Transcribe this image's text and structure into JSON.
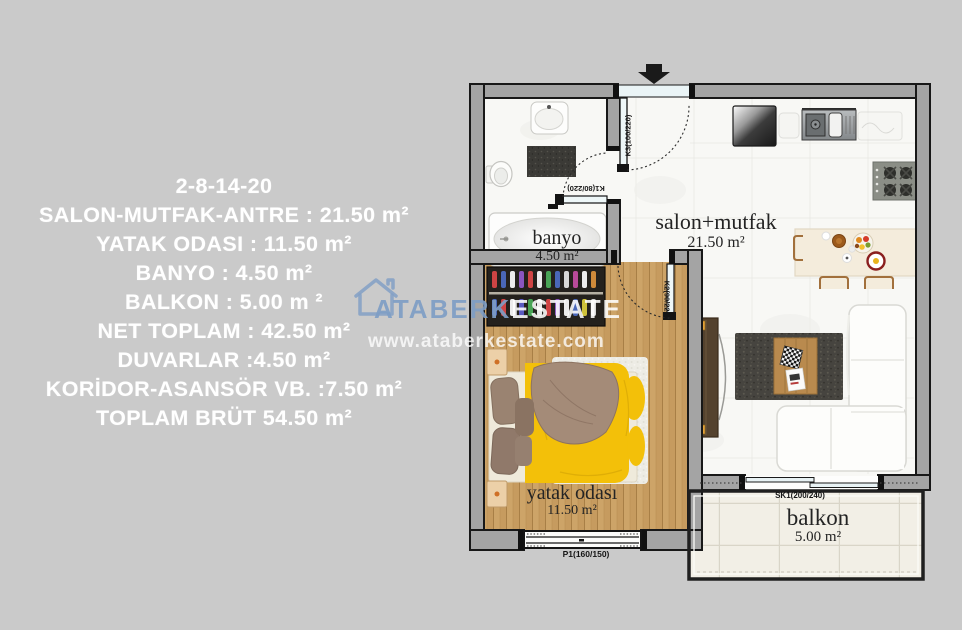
{
  "info_panel": {
    "lines": [
      "2-8-14-20",
      "SALON-MUTFAK-ANTRE  : 21.50 m²",
      "YATAK ODASI : 11.50 m²",
      "BANYO : 4.50 m²",
      "BALKON : 5.00 m ²",
      "NET TOPLAM : 42.50 m²",
      "DUVARLAR :4.50 m²",
      "KORİDOR-ASANSÖR VB. :7.50 m²",
      "TOPLAM BRÜT 54.50 m²"
    ]
  },
  "floor_plan": {
    "rooms": {
      "salon": {
        "name": "salon+mutfak",
        "area": "21.50 m²"
      },
      "banyo": {
        "name": "banyo",
        "area": "4.50 m²"
      },
      "yatak_odasi": {
        "name": "yatak odası",
        "area": "11.50 m²"
      },
      "balkon": {
        "name": "balkon",
        "area": "5.00 m²"
      }
    },
    "openings": {
      "entry_door": "K3(100/220)",
      "bath_door": "K1(80/220)",
      "bedroom_door": "K2(90/220)",
      "balcony_slider": "SK1(200/240)",
      "bedroom_window": "P1(160/150)"
    }
  },
  "watermark": {
    "brand_left": "ATABERK",
    "brand_right": "ESTATE",
    "url": "www.ataberkestate.com"
  },
  "colors": {
    "background": "#cacaca",
    "wall_fill": "#a4a4a4",
    "text_white": "#ffffff",
    "watermark_blue": "#7e9dc4",
    "bed_yellow": "#f3c009"
  }
}
